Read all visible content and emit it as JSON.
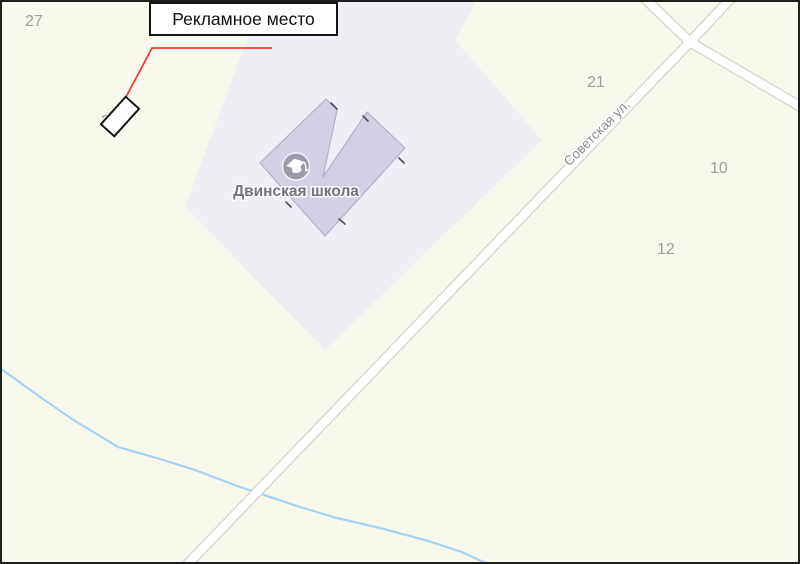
{
  "map": {
    "annotation": {
      "label": "Рекламное место",
      "line_color": "#f93a33"
    },
    "labels": {
      "school": "Двинская школа",
      "street": "Советская ул."
    },
    "house_numbers": [
      {
        "value": "27"
      },
      {
        "value": "25"
      },
      {
        "value": "21"
      },
      {
        "value": "10"
      },
      {
        "value": "12"
      }
    ],
    "colors": {
      "background": "#f8f8ec",
      "parcel": "#eeeef5",
      "building": "#d3d0e3",
      "building_border": "#b2aec8",
      "road_fill": "#ffffff",
      "road_casing": "#d4d2cb",
      "water": "#a7d3f3",
      "icon_bg": "#9c9aa9",
      "frame": "#1f1f1f"
    }
  }
}
